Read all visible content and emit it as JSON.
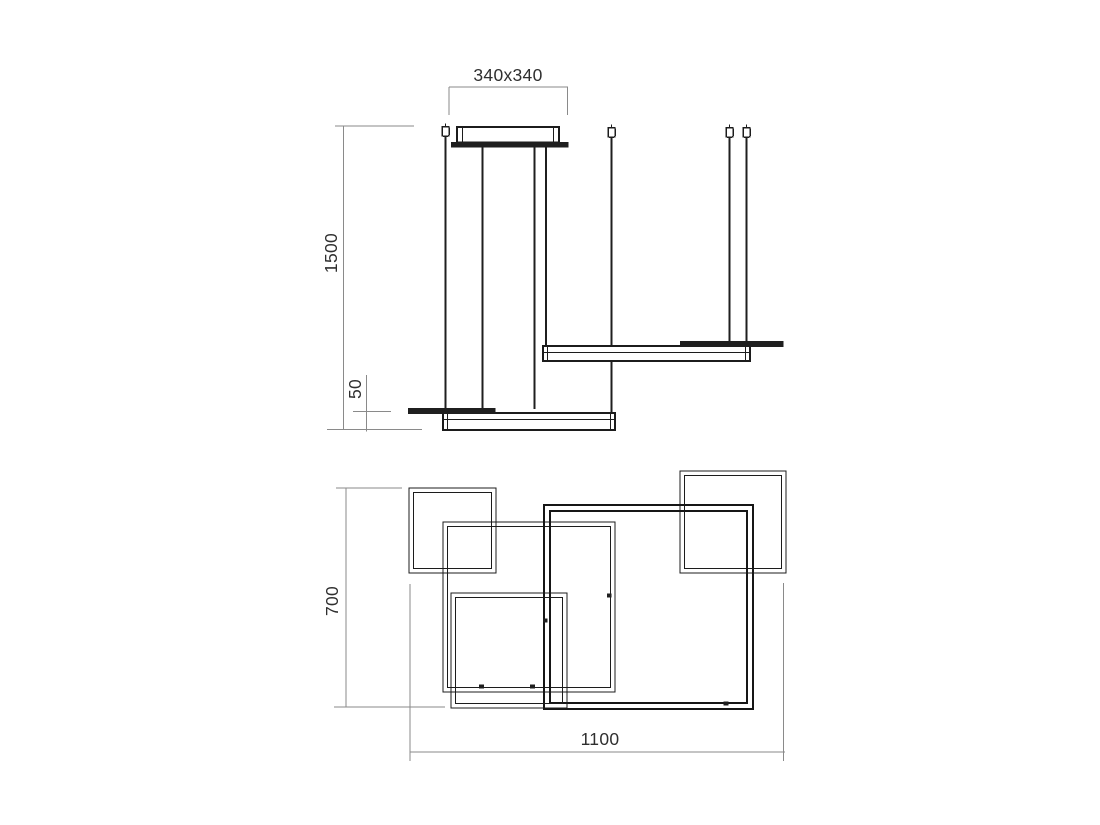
{
  "colors": {
    "background": "#ffffff",
    "object_line": "#1c1c1c",
    "dimension_line": "#8a8a8a",
    "text": "#2f2f2f"
  },
  "dimensions": {
    "canopy": "340x340",
    "suspension": "1500",
    "profile": "50",
    "depth": "700",
    "width": "1100"
  }
}
